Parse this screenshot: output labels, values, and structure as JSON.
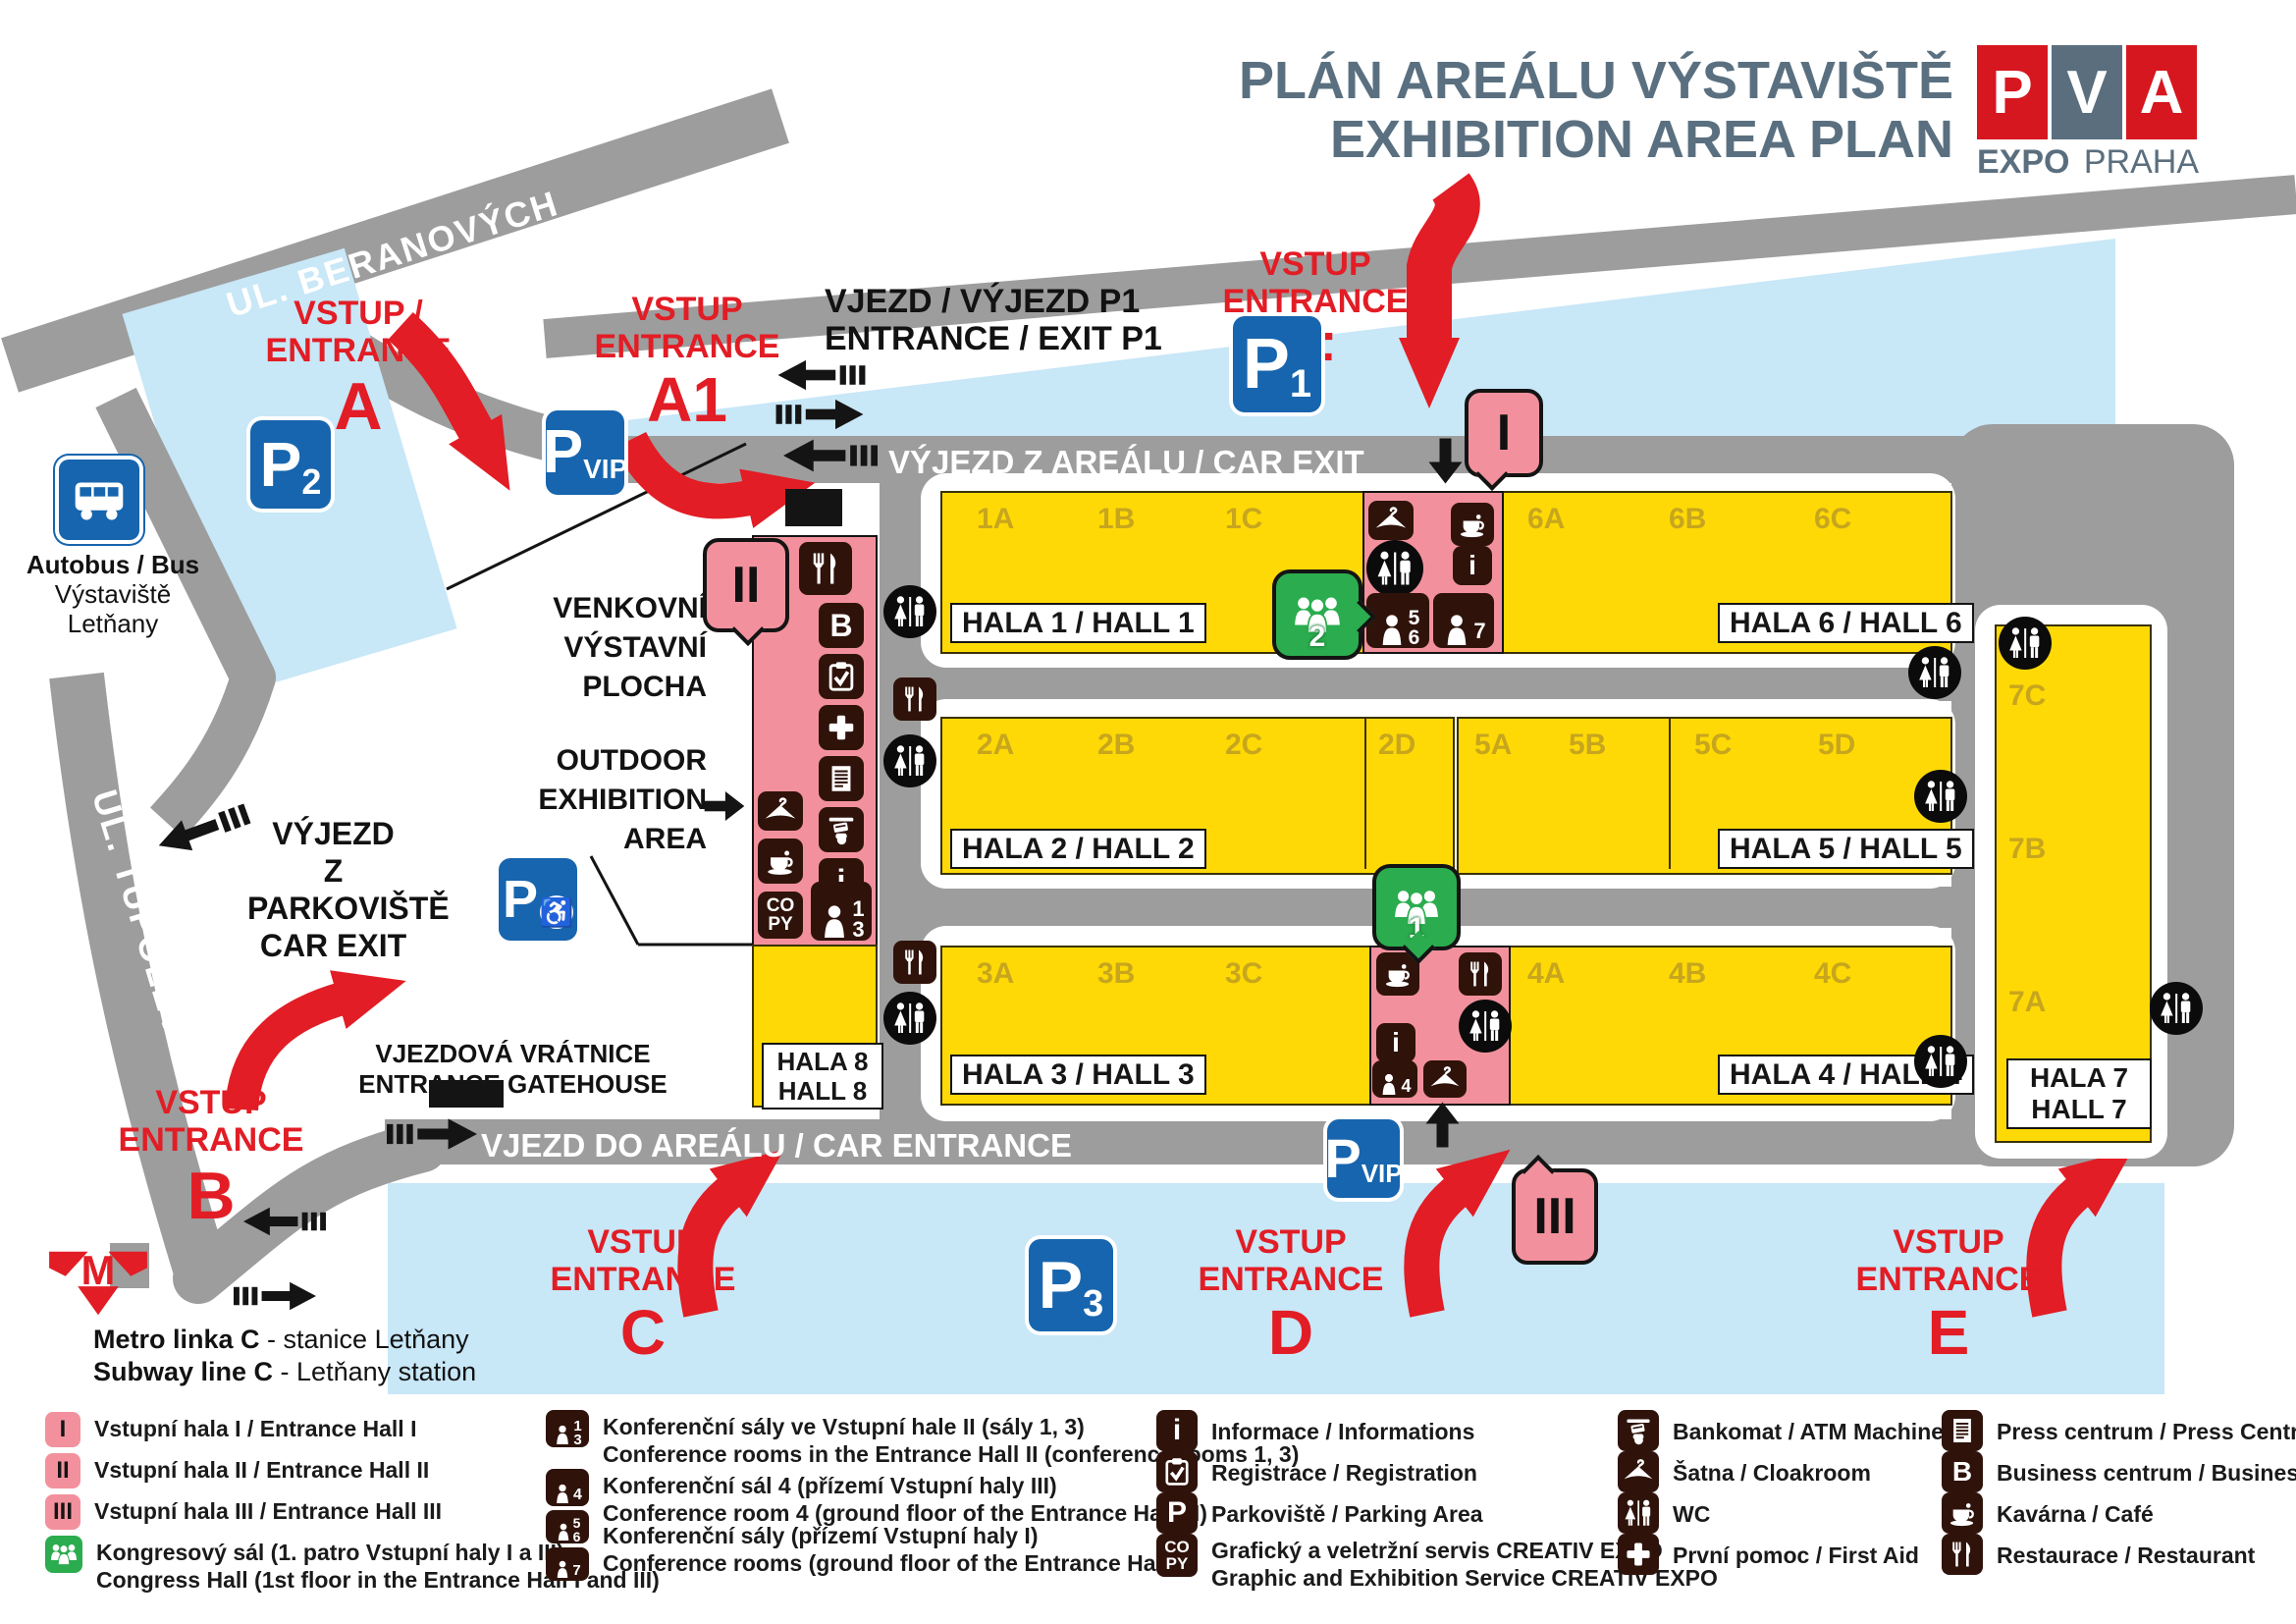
{
  "title": {
    "line1": "PLÁN AREÁLU VÝSTAVIŠTĚ",
    "line2": "EXHIBITION AREA PLAN"
  },
  "logo": {
    "p": "P",
    "v": "V",
    "a": "A",
    "expo": "EXPO",
    "praha": "PRAHA"
  },
  "streets": {
    "beranovych": "UL. BERANOVÝCH",
    "tupolevova": "UL. TUPOLEVOVA"
  },
  "road_labels": {
    "car_exit": "VÝJEZD Z AREÁLU / CAR EXIT",
    "car_entrance": "VJEZD DO AREÁLU / CAR ENTRANCE",
    "p1_gate_line1": "VJEZD / VÝJEZD P1",
    "p1_gate_line2": "ENTRANCE / EXIT P1",
    "parking_exit_line1": "VÝJEZD",
    "parking_exit_line2": "Z PARKOVIŠTĚ",
    "parking_exit_line3": "CAR EXIT",
    "gatehouse_line1": "VJEZDOVÁ VRÁTNICE",
    "gatehouse_line2": "ENTRANCE GATEHOUSE",
    "outdoor_cz1": "VENKOVNÍ",
    "outdoor_cz2": "VÝSTAVNÍ",
    "outdoor_cz3": "PLOCHA",
    "outdoor_en1": "OUTDOOR",
    "outdoor_en2": "EXHIBITION",
    "outdoor_en3": "AREA"
  },
  "entrances": {
    "a": {
      "caption": "VSTUP / ENTRANCE",
      "letter": "A"
    },
    "a1": {
      "line1": "VSTUP",
      "line2": "ENTRANCE",
      "letter": "A1"
    },
    "b": {
      "line1": "VSTUP",
      "line2": "ENTRANCE",
      "letter": "B"
    },
    "c": {
      "line1": "VSTUP",
      "line2": "ENTRANCE",
      "letter": "C"
    },
    "d": {
      "line1": "VSTUP",
      "line2": "ENTRANCE",
      "letter": "D"
    },
    "e": {
      "line1": "VSTUP",
      "line2": "ENTRANCE",
      "letter": "E"
    },
    "f": {
      "line1": "VSTUP",
      "line2": "ENTRANCE",
      "letter": "F"
    }
  },
  "parking_signs": {
    "p1": {
      "letter": "P",
      "sub": "1"
    },
    "p2": {
      "letter": "P",
      "sub": "2"
    },
    "p3": {
      "letter": "P",
      "sub": "3"
    },
    "pvip_top": {
      "letter": "P",
      "sub": "VIP"
    },
    "pvip_bottom": {
      "letter": "P",
      "sub": "VIP"
    },
    "pdisabled": {
      "letter": "P"
    }
  },
  "halls": {
    "hall1": {
      "zones": [
        "1A",
        "1B",
        "1C"
      ],
      "label": "HALA 1 / HALL 1"
    },
    "hall2": {
      "zones": [
        "2A",
        "2B",
        "2C",
        "2D"
      ],
      "label": "HALA 2 / HALL 2"
    },
    "hall3": {
      "zones": [
        "3A",
        "3B",
        "3C"
      ],
      "label": "HALA 3 / HALL 3"
    },
    "hall4": {
      "zones": [
        "4A",
        "4B",
        "4C"
      ],
      "label": "HALA 4 / HALL 4"
    },
    "hall5": {
      "zones": [
        "5A",
        "5B",
        "5C",
        "5D"
      ],
      "label": "HALA 5 / HALL 5"
    },
    "hall6": {
      "zones": [
        "6A",
        "6B",
        "6C"
      ],
      "label": "HALA 6 / HALL 6"
    },
    "hall7": {
      "zones": [
        "7C",
        "7B",
        "7A"
      ],
      "label1": "HALA 7",
      "label2": "HALL 7"
    },
    "hall8": {
      "label1": "HALA 8",
      "label2": "HALL 8"
    }
  },
  "markers": {
    "hall_i": "I",
    "hall_ii": "II",
    "hall_iii": "III",
    "congress1": "1",
    "congress2": "2"
  },
  "conference": {
    "n1": "1",
    "n3": "3",
    "n4": "4",
    "n5": "5",
    "n6": "6",
    "n7": "7"
  },
  "icon_letters": {
    "info": "i",
    "business": "B",
    "copy1": "CO",
    "copy2": "PY",
    "parking_p": "P"
  },
  "transport": {
    "bus1": "Autobus / Bus",
    "bus2": "Výstaviště Letňany",
    "metro1b": "Metro linka C",
    "metro1r": " - stanice Letňany",
    "metro2b": "Subway line C",
    "metro2r": " - Letňany station"
  },
  "legend": {
    "hall_i": {
      "line1": "Vstupní hala I / Entrance Hall I"
    },
    "hall_ii": {
      "line1": "Vstupní hala II / Entrance Hall II"
    },
    "hall_iii": {
      "line1": "Vstupní hala III / Entrance Hall III"
    },
    "congress": {
      "line1": "Kongresový sál (1. patro Vstupní haly I a III)",
      "line2": "Congress Hall (1st floor in the Entrance Hall I and III)"
    },
    "conf13": {
      "line1": "Konferenční sály ve Vstupní hale II (sály 1, 3)",
      "line2": "Conference rooms in the Entrance Hall II (conference rooms 1, 3)"
    },
    "conf4": {
      "line1": "Konferenční sál 4 (přízemí Vstupní haly III)",
      "line2": "Conference room 4 (ground floor of the Entrance Hall III)"
    },
    "conf567": {
      "line1": "Konferenční sály (přízemí Vstupní haly I)",
      "line2": "Conference rooms (ground floor of the Entrance Hall I)"
    },
    "info": {
      "line1": "Informace / Informations"
    },
    "registration": {
      "line1": "Registrace / Registration"
    },
    "parking": {
      "line1": "Parkoviště / Parking Area"
    },
    "creativ": {
      "line1": "Grafický a veletržní servis CREATIV EXPO",
      "line2": "Graphic and Exhibition Service CREATIV EXPO"
    },
    "atm": {
      "line1": "Bankomat / ATM Machine"
    },
    "cloakroom": {
      "line1": "Šatna / Cloakroom"
    },
    "wc": {
      "line1": "WC"
    },
    "firstaid": {
      "line1": "První pomoc / First Aid"
    },
    "press": {
      "line1": "Press centrum / Press Centre"
    },
    "business": {
      "line1": "Business centrum / Business Centre"
    },
    "cafe": {
      "line1": "Kavárna / Café"
    },
    "restaurant": {
      "line1": "Restaurace / Restaurant"
    }
  },
  "colors": {
    "road": "#9D9D9D",
    "parking_blue": "#C8E7F7",
    "hall_yellow": "#FFD905",
    "entrance_pink": "#F2919D",
    "accent_red": "#E21D25",
    "sign_blue": "#1765AE",
    "icon_dark": "#2F130B",
    "congress_green": "#2BAC4E",
    "title_slate": "#5A7080",
    "zone_label": "#C7A61E"
  }
}
